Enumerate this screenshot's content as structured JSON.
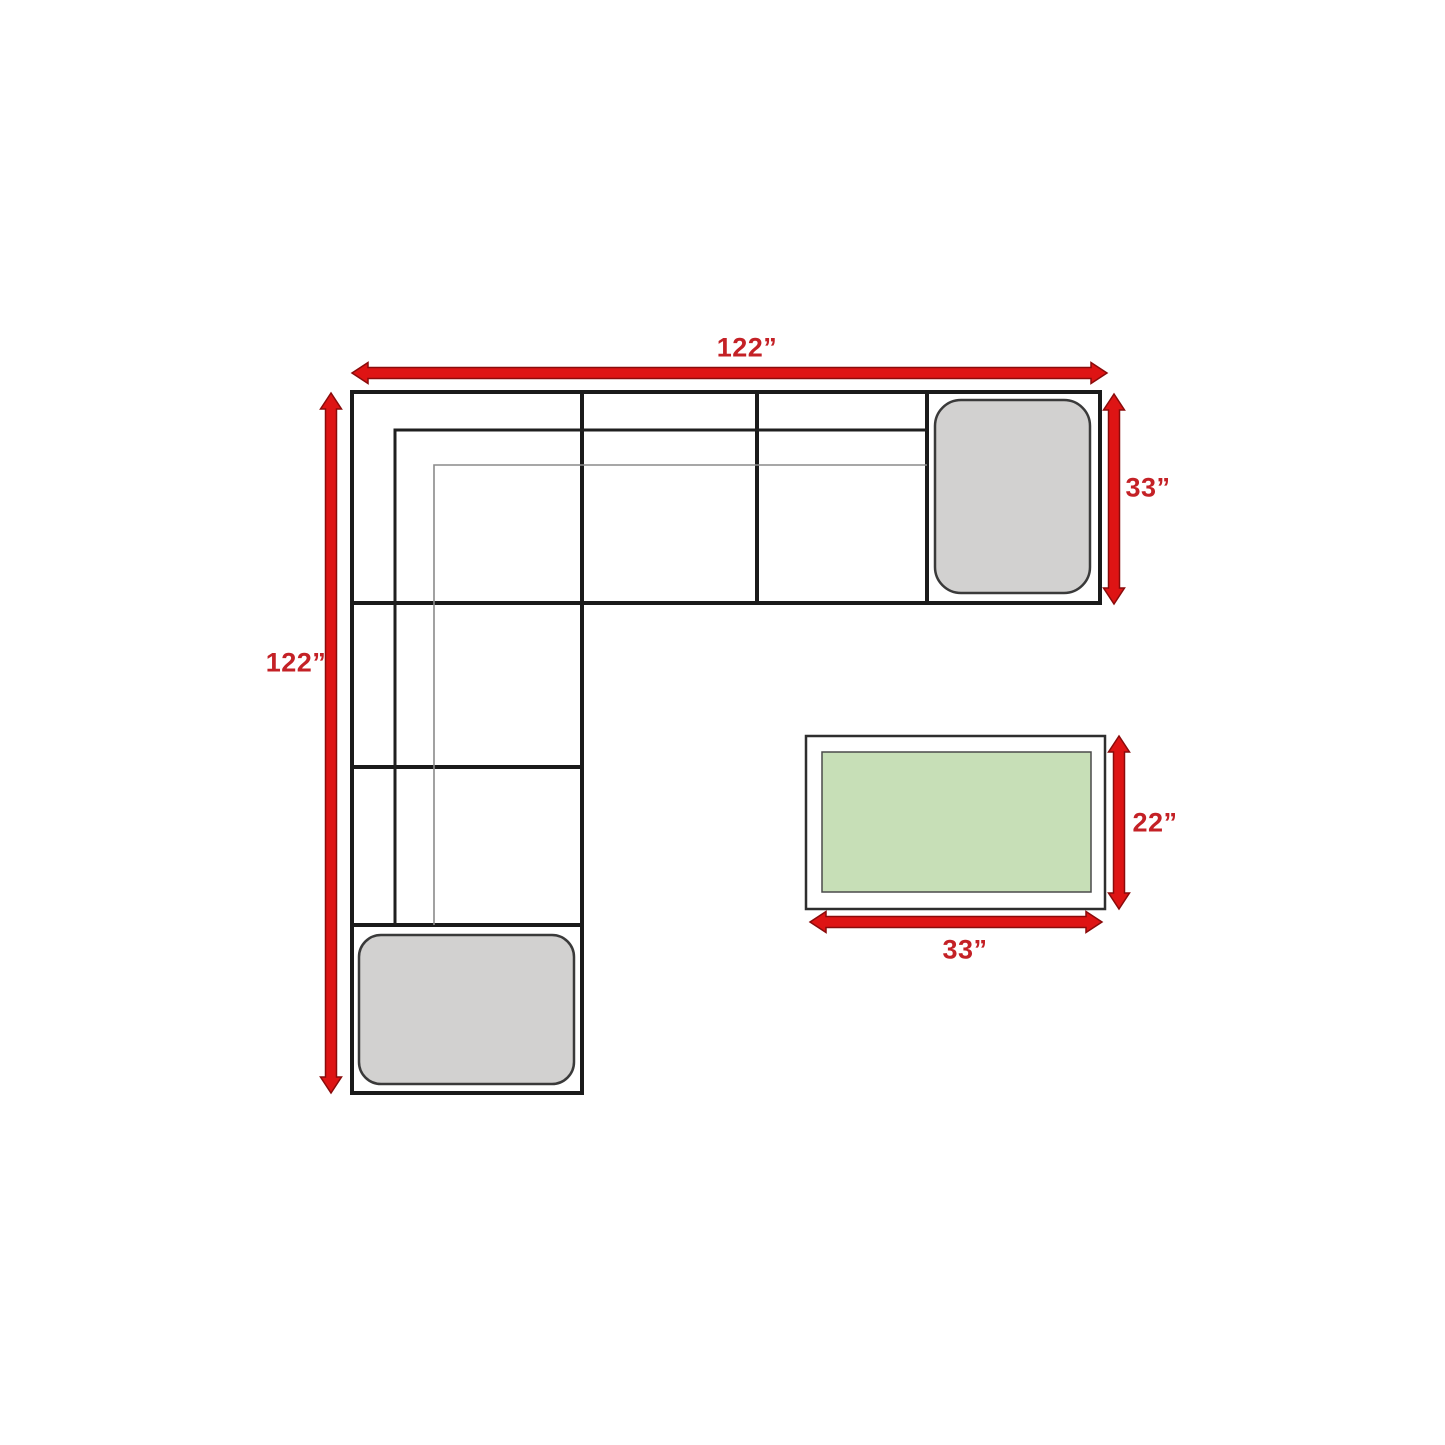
{
  "diagram": {
    "name": "sectional-sofa-dimension-diagram",
    "labels": {
      "sofa_width": "122”",
      "sofa_depth": "122”",
      "chaise_depth": "33”",
      "table_depth": "22”",
      "table_width": "33”"
    },
    "dimensions_inches": {
      "sofa_width": 122,
      "sofa_depth": 122,
      "chaise_depth": 33,
      "table_depth": 22,
      "table_width": 33
    },
    "colors": {
      "background": "#ffffff",
      "outline": "#1a1a1a",
      "inner_line": "#1f1f1f",
      "cushion_line": "#8a8a8a",
      "arrow_fill": "#de1414",
      "arrow_stroke": "#8a0b0b",
      "label_text": "#c42126",
      "cushion_fill": "#d2d1d0",
      "cushion_stroke": "#3a3a3a",
      "table_fill": "#ffffff",
      "table_stroke": "#2e2e2e",
      "tabletop_fill": "#c7dfb7",
      "tabletop_stroke": "#4a4a4a"
    }
  }
}
